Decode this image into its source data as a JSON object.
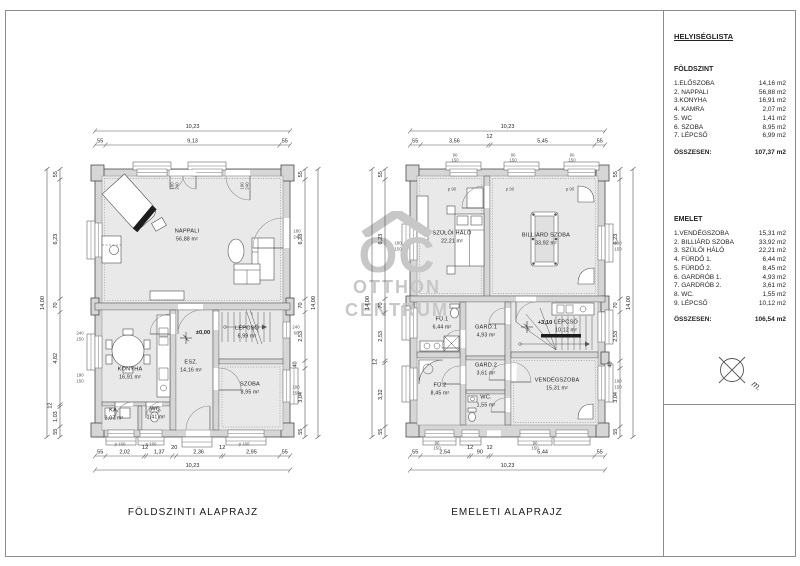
{
  "legend": {
    "title": "HELYISÉGLISTA",
    "sections": [
      {
        "heading": "FÖLDSZINT",
        "rows": [
          {
            "name": "1.ELŐSZOBA",
            "area": "14,16 m2"
          },
          {
            "name": "2. NAPPALI",
            "area": "56,88 m2"
          },
          {
            "name": "3.KONYHA",
            "area": "16,91 m2"
          },
          {
            "name": "4. KAMRA",
            "area": "2,07 m2"
          },
          {
            "name": "5. WC",
            "area": "1,41 m2"
          },
          {
            "name": "6. SZOBA",
            "area": "8,95 m2"
          },
          {
            "name": "7. LÉPCSŐ",
            "area": "6,99 m2"
          }
        ],
        "total_label": "ÖSSZESEN:",
        "total_value": "107,37 m2"
      },
      {
        "heading": "EMELET",
        "rows": [
          {
            "name": "1.VENDÉGSZOBA",
            "area": "15,31 m2"
          },
          {
            "name": "2. BILLIÁRD SZOBA",
            "area": "33,92 m2"
          },
          {
            "name": "3. SZÜLŐI HÁLÓ",
            "area": "22,21 m2"
          },
          {
            "name": "4. FÜRDŐ 1.",
            "area": "6,44 m2"
          },
          {
            "name": "5. FÜRDŐ 2.",
            "area": "8,45 m2"
          },
          {
            "name": "6. GARDRÓB 1.",
            "area": "4,93 m2"
          },
          {
            "name": "7. GARDRÓB 2.",
            "area": "3,61 m2"
          },
          {
            "name": "8. WC.",
            "area": "1,55 m2"
          },
          {
            "name": "9. LÉPCSŐ",
            "area": "10,12 m2"
          }
        ],
        "total_label": "ÖSSZESEN:",
        "total_value": "106,54 m2"
      }
    ],
    "compass_label": "m."
  },
  "ground": {
    "title": "FÖLDSZINTI ALAPRAJZ",
    "level": "±0,00",
    "rooms": [
      {
        "name": "NAPPALI",
        "area": "56,88 m²"
      },
      {
        "name": "KONYHA",
        "area": "16,91 m²"
      },
      {
        "name": "ESZ.",
        "area": "14,16 m²"
      },
      {
        "name": "LÉPCSŐ",
        "area": "6,99 m²"
      },
      {
        "name": "SZOBA",
        "area": "8,95 m²"
      },
      {
        "name": "KA.",
        "area": "2,07 m²"
      },
      {
        "name": "WC.",
        "area": "1,41 m²"
      }
    ],
    "dims": {
      "top": [
        "55",
        "9,13",
        "55"
      ],
      "top_total": "10,23",
      "bottom": [
        "55",
        "2,02",
        "12",
        "1,37",
        "20",
        "2,36",
        "12",
        "2,95",
        "55"
      ],
      "bottom_total": "10,23",
      "left": [
        "55",
        "6,23",
        "70",
        "4,82",
        "12",
        "1,03",
        "55"
      ],
      "left_total": "14,00",
      "right": [
        "55",
        "6,23",
        "70",
        "2,53",
        "40",
        "3,04",
        "55"
      ],
      "right_total": "14,00"
    }
  },
  "upper": {
    "title": "EMELETI ALAPRAJZ",
    "level": "+3,10",
    "rooms": [
      {
        "name": "SZÜLŐI HÁLÓ",
        "area": "22,21 m²"
      },
      {
        "name": "BILLIÁRD SZOBA",
        "area": "33,92 m²"
      },
      {
        "name": "FÜ.1",
        "area": "6,44 m²"
      },
      {
        "name": "GARD.1",
        "area": "4,93 m²"
      },
      {
        "name": "FÜ.2",
        "area": "8,45 m²"
      },
      {
        "name": "GARD.2",
        "area": "3,61 m²"
      },
      {
        "name": "WC.",
        "area": "1,55 m²"
      },
      {
        "name": "VENDÉGSZOBA",
        "area": "15,31 m²"
      },
      {
        "name": "LÉPCSŐ",
        "area": "10,12 m²"
      }
    ],
    "dims": {
      "top": [
        "55",
        "3,56",
        "12",
        "5,45",
        "55"
      ],
      "top_total": "10,23",
      "bottom": [
        "55",
        "2,54",
        "12",
        "90",
        "12",
        "5,44",
        "55"
      ],
      "bottom_total": "10,23",
      "left": [
        "55",
        "6,23",
        "70",
        "2,53",
        "12",
        "3,32",
        "55"
      ],
      "left_total": "14,00",
      "right": [
        "55",
        "6,23",
        "70",
        "2,53",
        "40",
        "3,04",
        "55"
      ],
      "right_total": "14,00"
    }
  },
  "tiny": {
    "w90": "90",
    "w150": "150",
    "w190": "190",
    "w240": "240",
    "w60": "60",
    "w180": "180",
    "p90": "p 90",
    "p160": "p 160"
  },
  "watermark": {
    "brand": "OC",
    "line1": "OTTHON",
    "line2": "CENTRUM"
  }
}
